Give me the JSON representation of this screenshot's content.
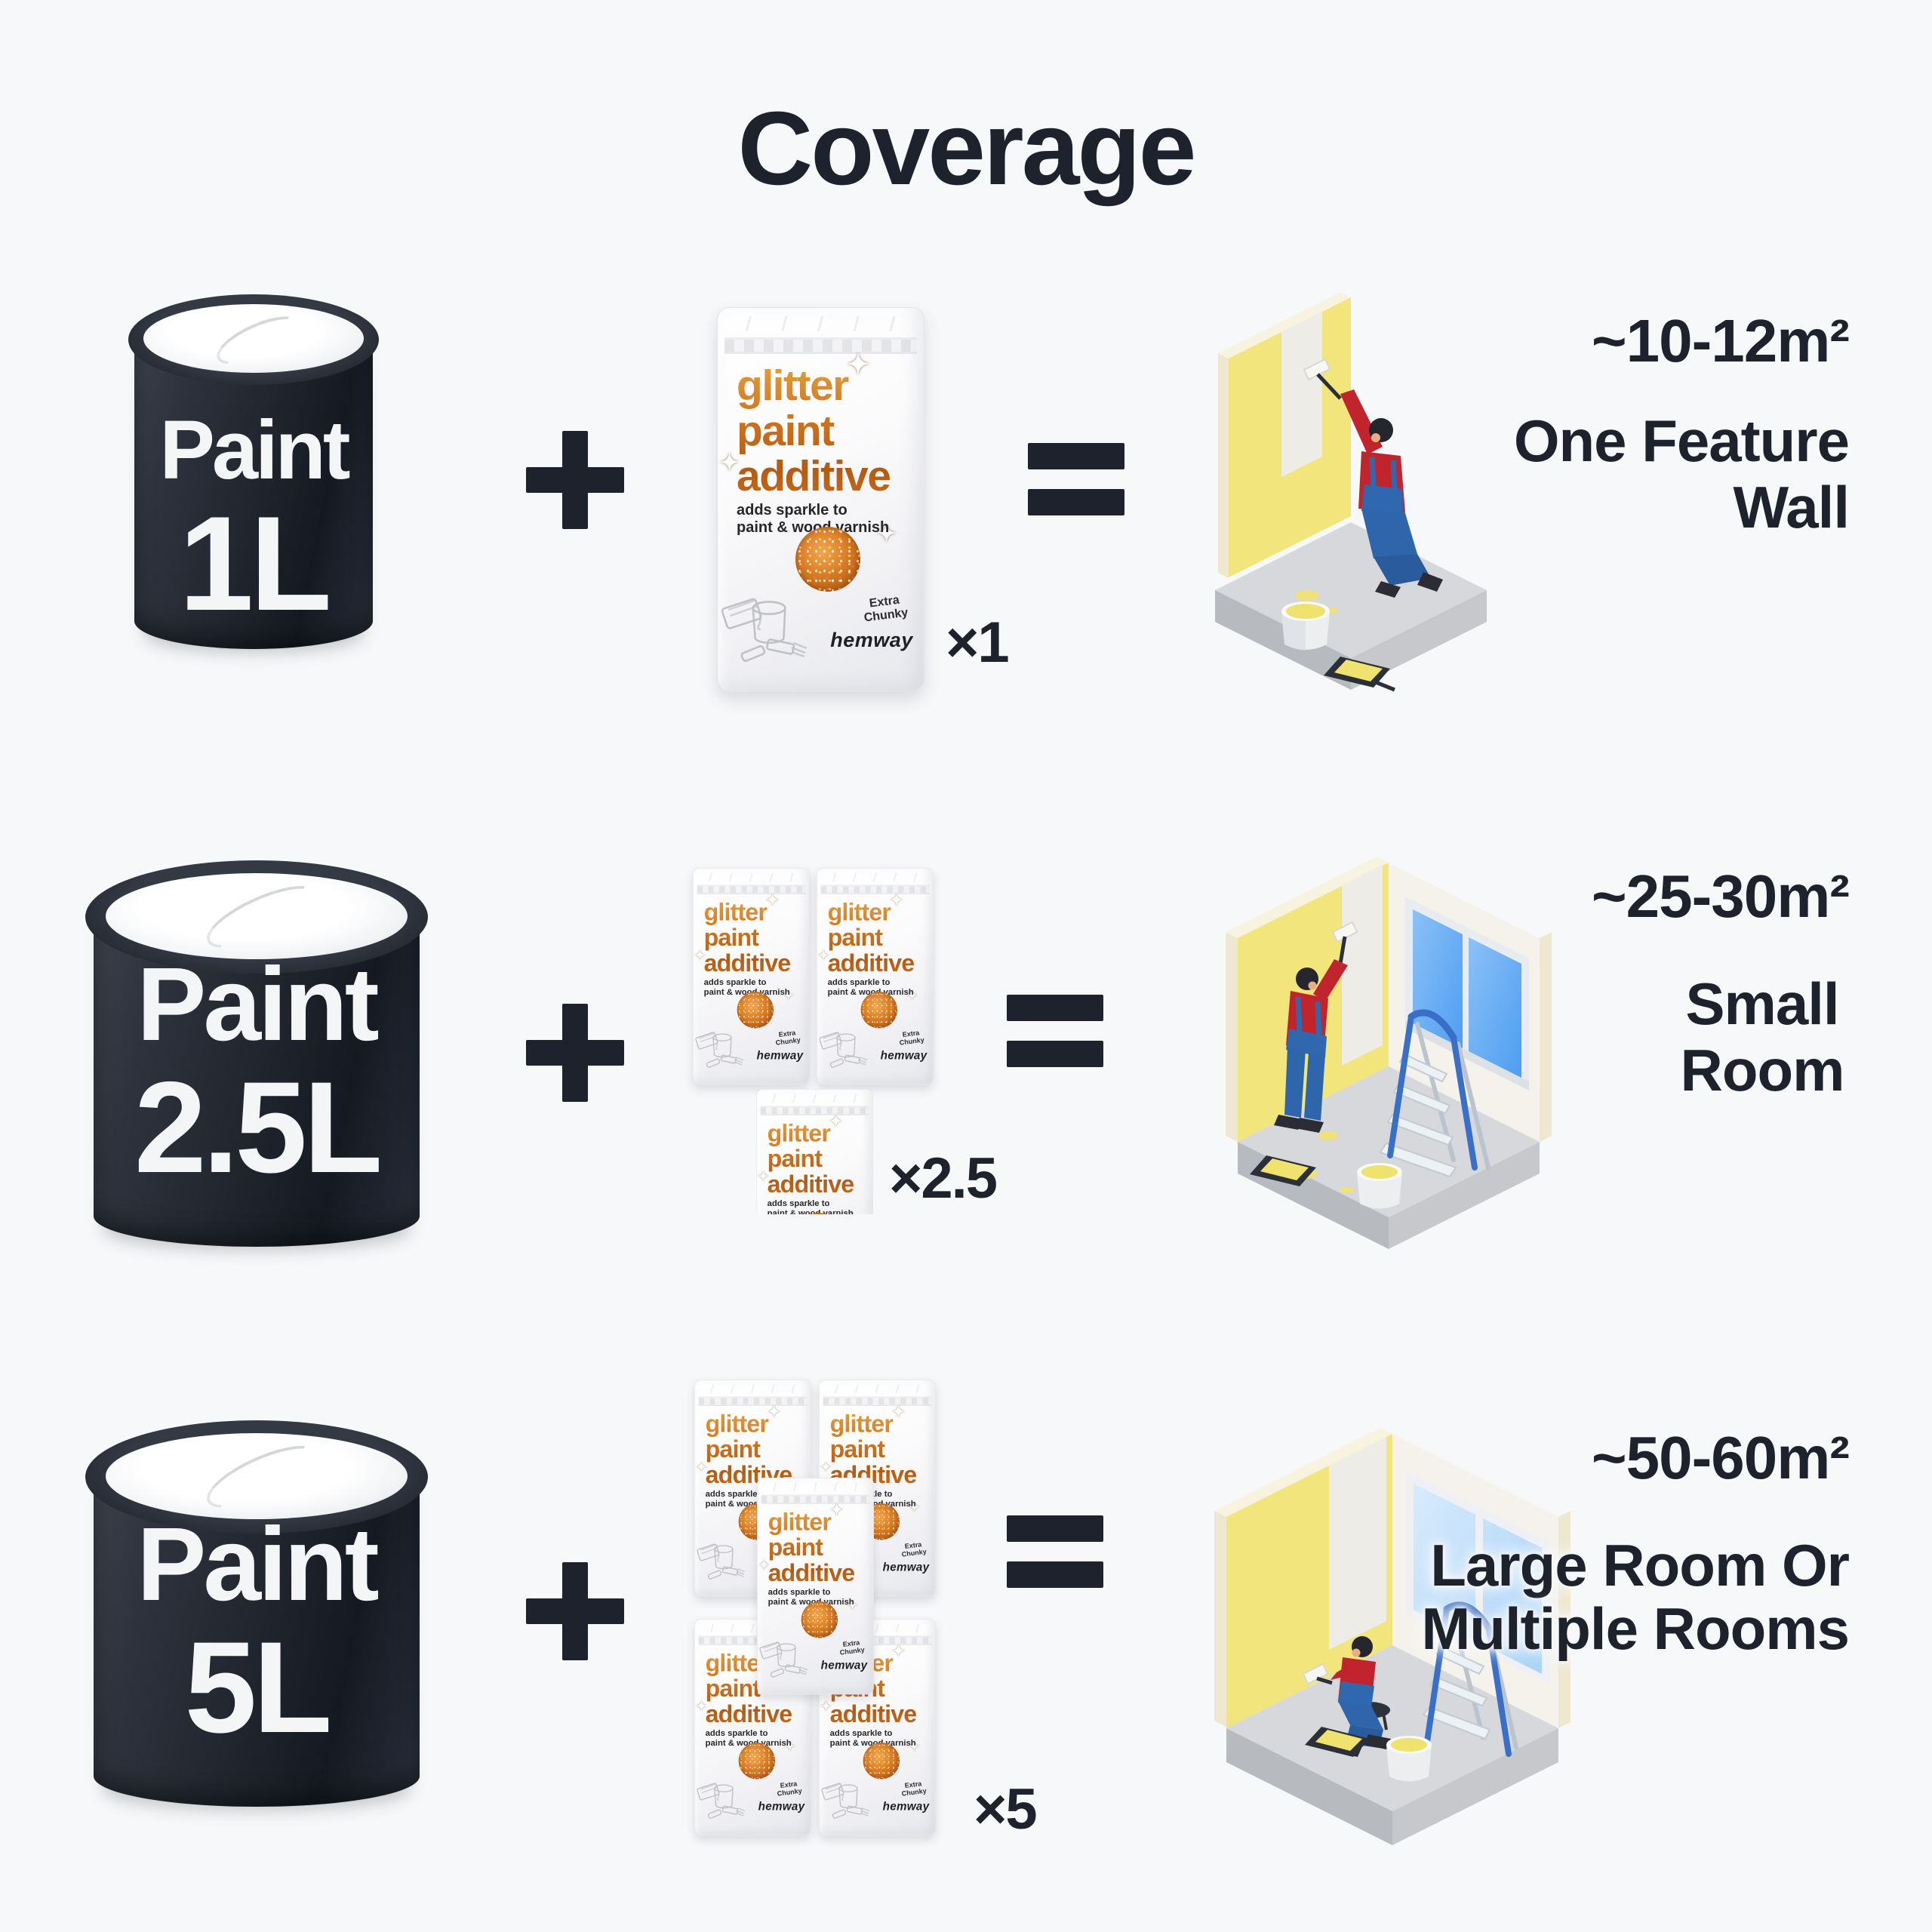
{
  "title": "Coverage",
  "rows": [
    {
      "can_label": "Paint",
      "can_size": "1L",
      "multiplier": "×1",
      "area": "~10-12m²",
      "result_lines": [
        "One Feature",
        "Wall"
      ]
    },
    {
      "can_label": "Paint",
      "can_size": "2.5L",
      "multiplier": "×2.5",
      "area": "~25-30m²",
      "result_lines": [
        "Small",
        "Room"
      ]
    },
    {
      "can_label": "Paint",
      "can_size": "5L",
      "multiplier": "×5",
      "area": "~50-60m²",
      "result_lines": [
        "Large Room Or",
        "Multiple Rooms"
      ]
    }
  ],
  "pouch": {
    "title_line1": "glitter",
    "title_line2": "paint",
    "title_line3": "additive",
    "tagline_line1": "adds sparkle to",
    "tagline_line2": "paint & wood varnish",
    "variant_line1": "Extra",
    "variant_line2": "Chunky",
    "brand": "hemway"
  },
  "icons": {
    "sparkle": "✦",
    "plus": "plus-sign",
    "equals": "equals-sign"
  },
  "colors": {
    "background": "#f7f8fa",
    "ink": "#1d222c",
    "can_body": "#21262f",
    "pouch_orange": "#cf751f",
    "wall_yellow": "#f2e57c",
    "window_blue": "#5ba4f0",
    "painter_shirt_red": "#c2242e",
    "painter_overalls_blue": "#3068b0",
    "floor_gray": "#d5d7da",
    "paint_yellow": "#f0e26e"
  }
}
